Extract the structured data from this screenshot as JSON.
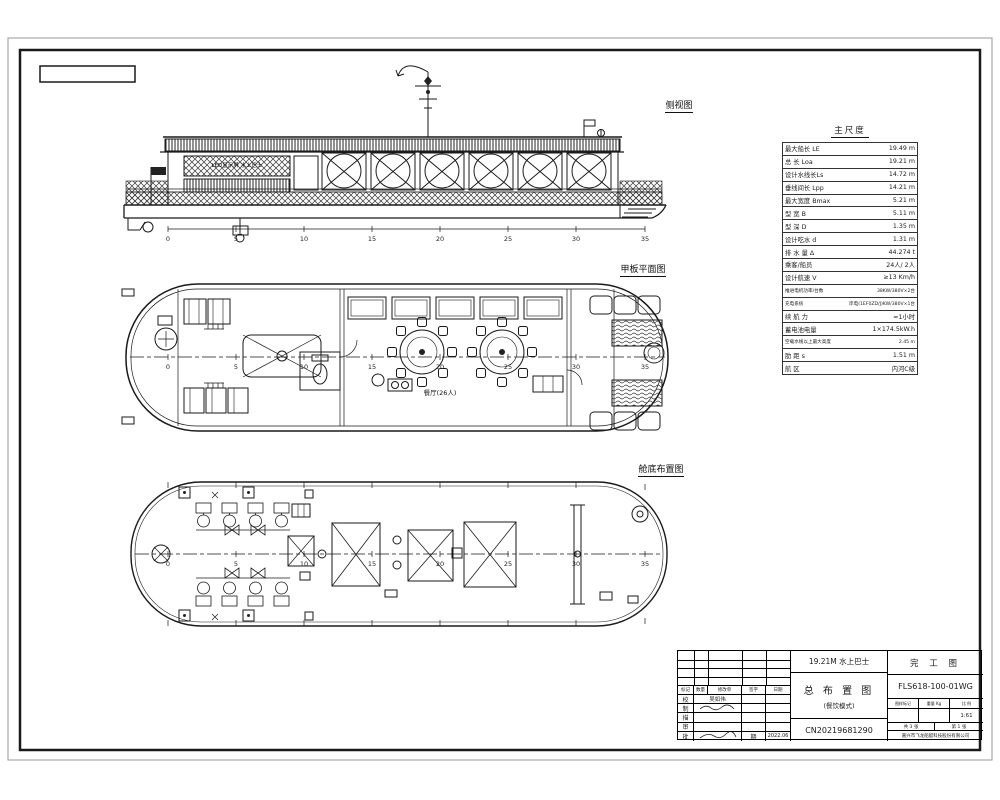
{
  "colors": {
    "ink": "#1a1a1a",
    "paper": "#ffffff",
    "frame_outer": "#999999"
  },
  "stations": [
    "0",
    "5",
    "10",
    "15",
    "20",
    "25",
    "30",
    "35"
  ],
  "views": {
    "side": {
      "label": "侧视图",
      "led_text": "LED显示屏 水上巴士"
    },
    "deck": {
      "label": "甲板平面图",
      "dining_label": "餐厅(26人)"
    },
    "bilge": {
      "label": "舱底布置图"
    }
  },
  "spec": {
    "title": "主尺度",
    "rows": [
      {
        "label": "最大船长 LE",
        "value": "19.49 m"
      },
      {
        "label": "总   长 Loa",
        "value": "19.21 m"
      },
      {
        "label": "设计水线长Ls",
        "value": "14.72 m"
      },
      {
        "label": "垂线间长 Lpp",
        "value": "14.21 m"
      },
      {
        "label": "最大宽度 Bmax",
        "value": "5.21 m"
      },
      {
        "label": "型   宽 B",
        "value": "5.11 m"
      },
      {
        "label": "型   深 D",
        "value": "1.35 m"
      },
      {
        "label": "设计吃水 d",
        "value": "1.31 m"
      },
      {
        "label": "排 水 量 Δ",
        "value": "44.274 t"
      },
      {
        "label": "乘客/船员",
        "value": "24人/ 2人"
      },
      {
        "label": "设计航速 V",
        "value": "≥13 Km/h"
      },
      {
        "label": "推进电机功率/台数",
        "value": "38KW/380V×2台"
      },
      {
        "label": "充电系统",
        "value": "岸电(1EF0ZD/J)KW/380V×1台"
      },
      {
        "label": "续 航 力",
        "value": "≈1小时"
      },
      {
        "label": "蓄电池电量",
        "value": "1×174.5kW.h"
      },
      {
        "label": "空载水线以上最大高度",
        "value": "2.45 m"
      },
      {
        "label": "肋   距 s",
        "value": "1.51 m"
      },
      {
        "label": "航   区",
        "value": "内河C级"
      }
    ]
  },
  "tb": {
    "project": "19.21M 水上巴士",
    "stage": "完 工 图",
    "drawing_no": "FLS618-100-01WG",
    "title": "总 布 置 图",
    "subtitle": "(餐饮模式)",
    "serial": "CN20219681290",
    "company": "嘉兴市飞龙船艇科技股份有限公司",
    "hdr": [
      "图样标记",
      "重量 Kg",
      "比 例"
    ],
    "scale": "1:61",
    "sheets": [
      "共 3 张",
      "第 1 张"
    ],
    "rev_header": [
      "标记",
      "数量",
      "修改单",
      "签字",
      "日期"
    ],
    "rows": [
      {
        "label": "校",
        "name": "吴如伟"
      },
      {
        "label": "制",
        "name": ""
      },
      {
        "label": "描",
        "name": ""
      },
      {
        "label": "审",
        "name": ""
      },
      {
        "label": "批",
        "name": ""
      }
    ],
    "date_label": "期",
    "date": "2022.06"
  }
}
